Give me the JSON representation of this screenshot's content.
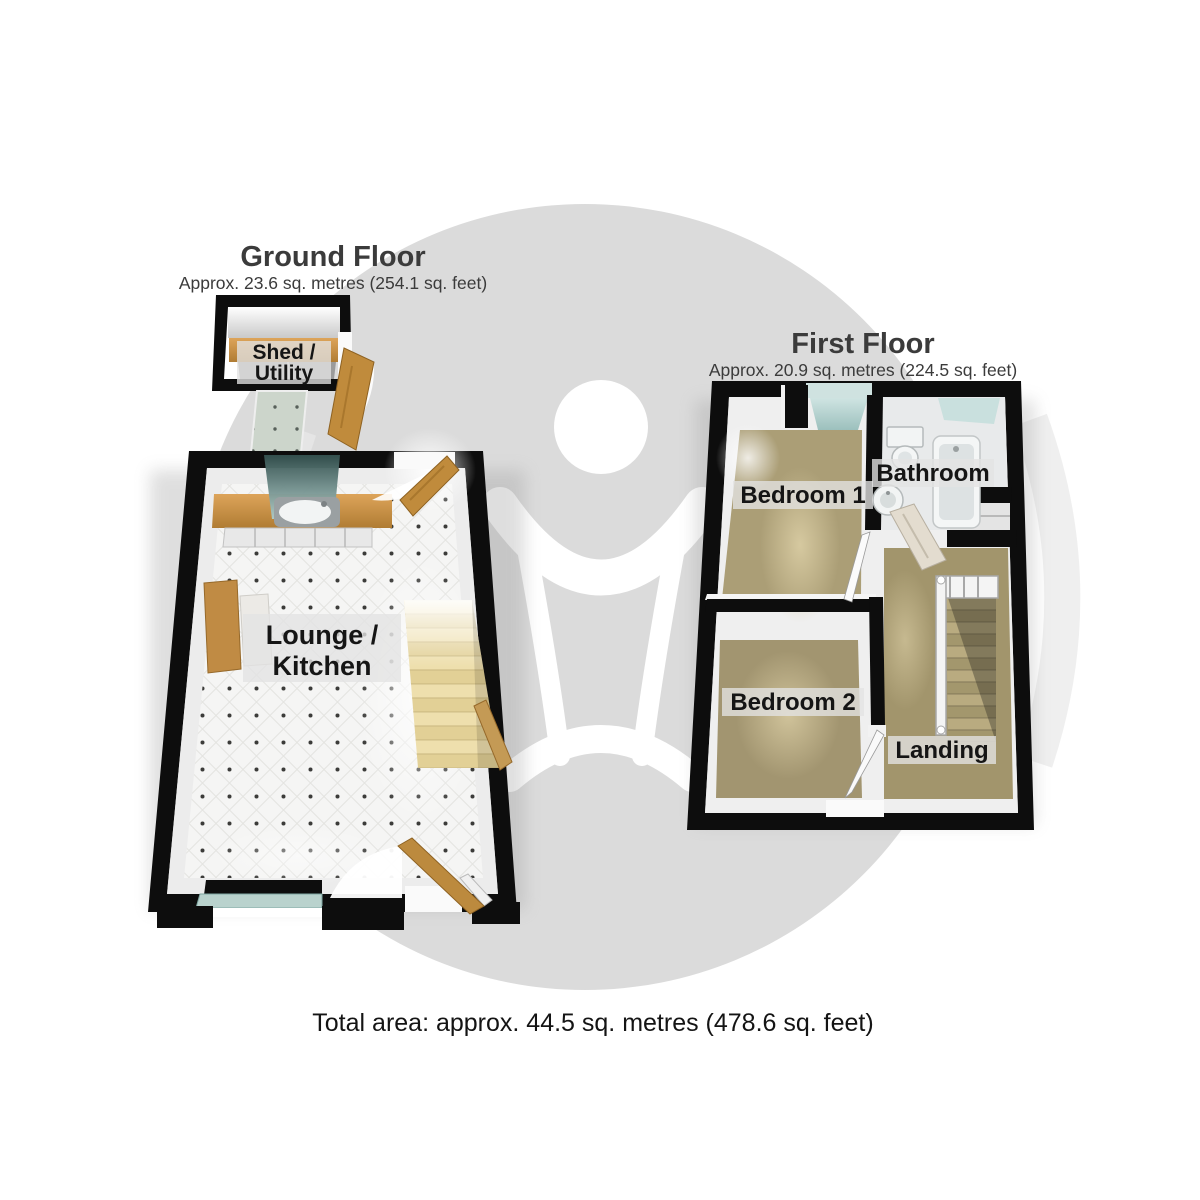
{
  "ground_floor": {
    "title": "Ground Floor",
    "subtitle": "Approx. 23.6 sq. metres (254.1 sq. feet)",
    "shed_label_line1": "Shed /",
    "shed_label_line2": "Utility",
    "lounge_label_line1": "Lounge /",
    "lounge_label_line2": "Kitchen"
  },
  "first_floor": {
    "title": "First Floor",
    "subtitle": "Approx. 20.9 sq. metres (224.5 sq. feet)",
    "bedroom1_label": "Bedroom 1",
    "bathroom_label": "Bathroom",
    "bedroom2_label": "Bedroom 2",
    "landing_label": "Landing"
  },
  "footer": {
    "total_area": "Total area: approx. 44.5 sq. metres (478.6 sq. feet)"
  },
  "colors": {
    "watermark_circle": "#dbdbdb",
    "watermark_figure": "#ffffff",
    "wall": "#0d0d0d",
    "wood": "#c08b3c",
    "carpet": "#a89b73",
    "tile_floor": "#f4f4f3",
    "glass": "#9fc3c0",
    "stairs_ground": "#ecdca8",
    "title_text": "#3b3b3b",
    "label_text": "#151515"
  }
}
